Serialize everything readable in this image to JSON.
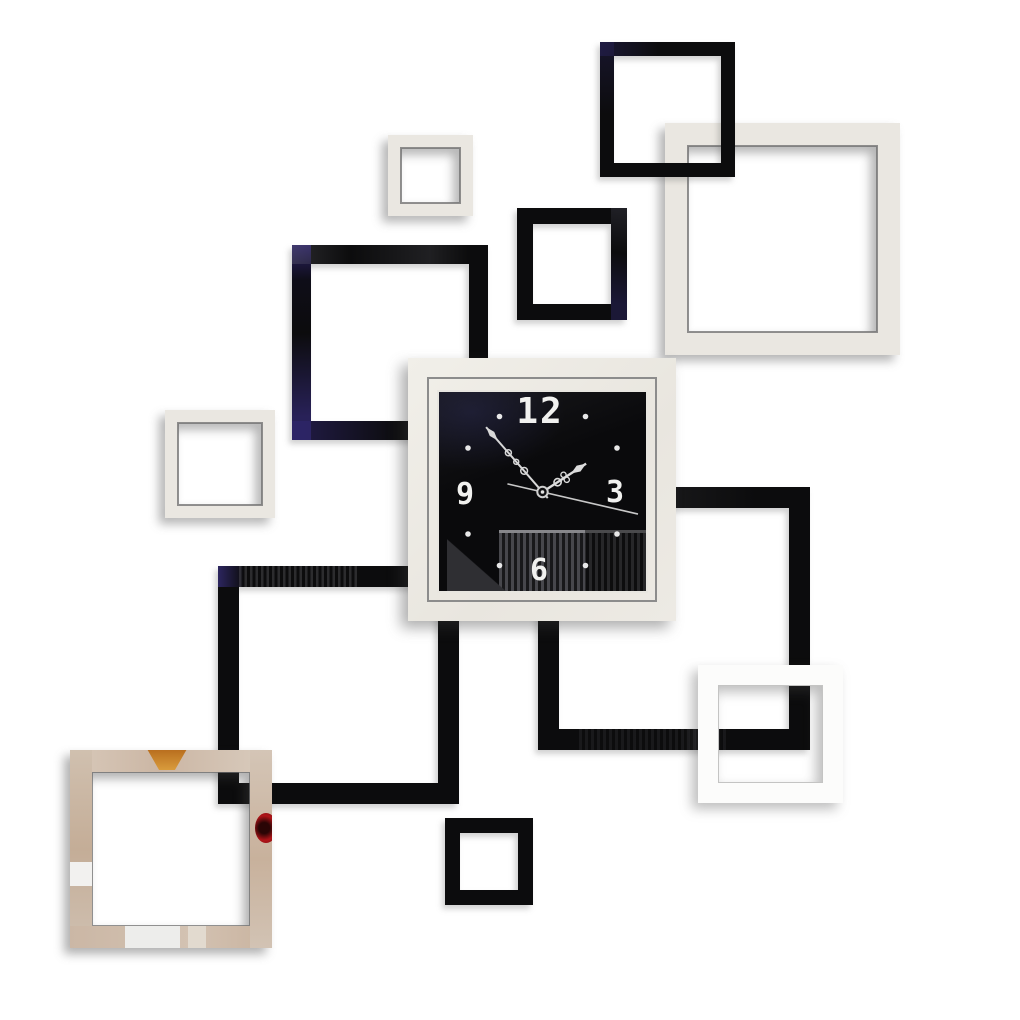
{
  "scene": {
    "description": "DIY 3D acrylic mirror wall clock sticker set: overlapping black and silver square frames on a white wall with a central square clock",
    "wall_color": "#ffffff"
  },
  "clock": {
    "numeral_top": "12",
    "numeral_right": "3",
    "numeral_bottom": "6",
    "numeral_left": "9",
    "marker_dot_hours": [
      1,
      2,
      4,
      5,
      7,
      8,
      10,
      11
    ],
    "hands": {
      "hour_angle_deg": 57,
      "minute_angle_deg": -41,
      "second_angle_deg": 103
    }
  },
  "palette": {
    "black_acrylic": "#0c0c0d",
    "silver_acrylic": "#eae7e1",
    "white_acrylic": "#fcfcfb",
    "clock_face": "#0a0a0c",
    "hands_and_markers": "#e8e8e8",
    "frame_inner_line": "#8c8c8c",
    "reflection_lamp_amber": "#cf8a2e",
    "reflection_red": "#b01418",
    "reflection_beige": "#cdb9a7"
  }
}
